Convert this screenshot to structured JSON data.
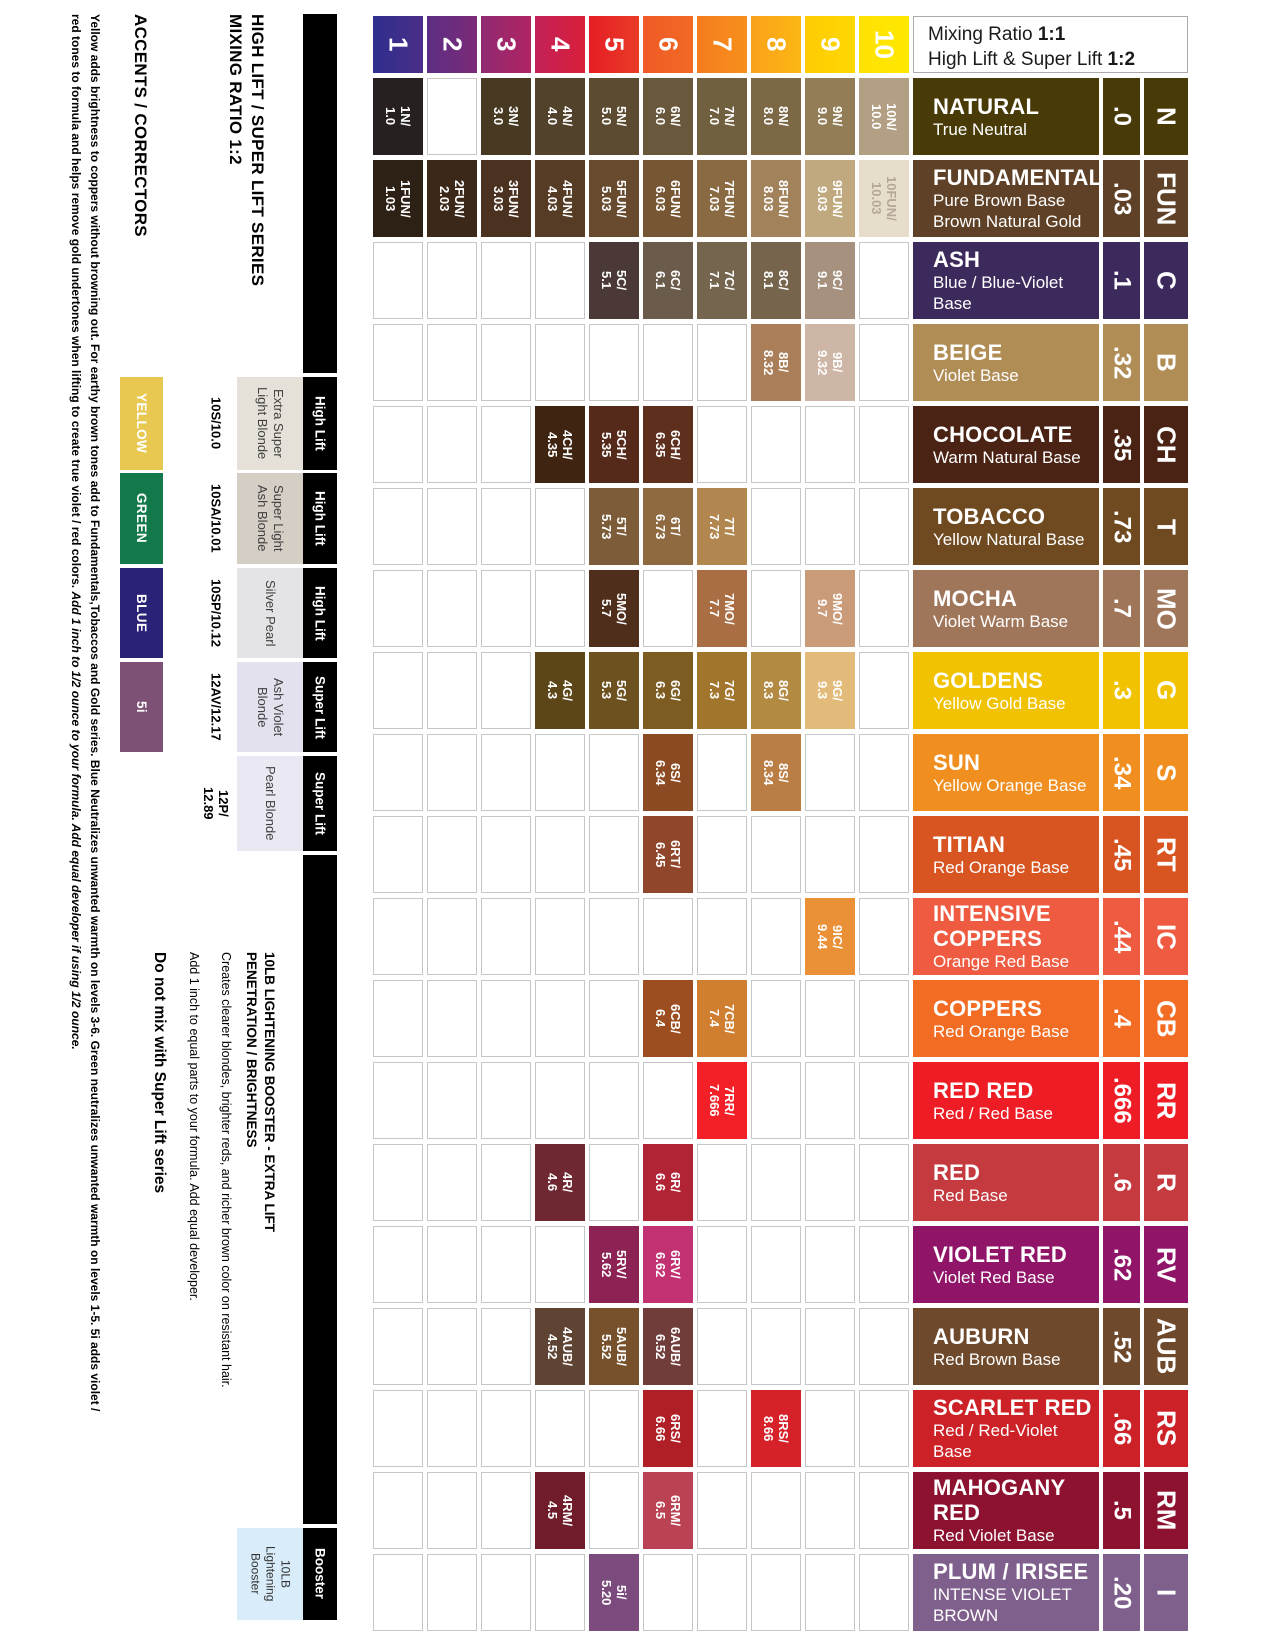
{
  "headings": {
    "series_line1": "HIGH LIFT / SUPER LIFT SERIES",
    "series_line2": "MIXING RATIO 1:2",
    "accents": "ACCENTS / CORRECTORS"
  },
  "mixing_ratio": {
    "line1_label": "Mixing Ratio ",
    "line1_value": "1:1",
    "line2_label": "High Lift & Super Lift ",
    "line2_value": "1:2"
  },
  "footnote": {
    "line1": "Yellow adds brightness to coppers without browning out. For earthy brown tones add to Fundamentals,Tobaccos and Gold series. Blue Neutralizes unwanted warmth on levels 3-6. Green neutralizes unwanted warmth on levels 1-5. 5i adds violet /",
    "line2": "red tones to formula and helps remove gold undertones when lifting to create true violet / red colors. ",
    "line2_italic": "Add 1 inch to 1/2 ounce to your formula. Add equal developer if using 1/2 ounce."
  },
  "info_block": {
    "heading_line1": "10LB LIGHTENING BOOSTER - EXTRA LIFT",
    "heading_line2": "PENETRATION / BRIGHTNESS",
    "body1": "Creates clearer blondes, brighter reds, and richer brown color on resistant hair.",
    "body2": "Add 1 inch to equal parts to your formula. Add equal developer.",
    "warning": "Do not mix with Super Lift series"
  },
  "levels": [
    {
      "num": "1",
      "color": "#2e2f8e",
      "color2": "#4b2d87"
    },
    {
      "num": "2",
      "color": "#5c2d83",
      "color2": "#7c2b78"
    },
    {
      "num": "3",
      "color": "#8f2a70",
      "color2": "#b02464"
    },
    {
      "num": "4",
      "color": "#c22158",
      "color2": "#d91f3a"
    },
    {
      "num": "5",
      "color": "#e51e25",
      "color2": "#ea3b27"
    },
    {
      "num": "6",
      "color": "#ef5a28",
      "color2": "#f26a23"
    },
    {
      "num": "7",
      "color": "#f47c1e",
      "color2": "#f7901c"
    },
    {
      "num": "8",
      "color": "#f9a11b",
      "color2": "#fcb713"
    },
    {
      "num": "9",
      "color": "#fecb04",
      "color2": "#ffd800"
    },
    {
      "num": "10",
      "color": "#ffe103",
      "color2": "#ffe800"
    }
  ],
  "accents": [
    {
      "label": "YELLOW",
      "color": "#e9c851"
    },
    {
      "label": "GREEN",
      "color": "#13794b"
    },
    {
      "label": "BLUE",
      "color": "#2a2276"
    },
    {
      "label": "5i",
      "color": "#7d5076"
    }
  ],
  "products": [
    {
      "code_lines": [
        "10S/10.0"
      ],
      "name_lines": [
        "Extra Super",
        "Light Blonde"
      ],
      "bg": "#e5e1d8"
    },
    {
      "code_lines": [
        "10SA/10.01"
      ],
      "name_lines": [
        "Super Light",
        "Ash Blonde"
      ],
      "bg": "#d5cec5"
    },
    {
      "code_lines": [
        "10SP/10.12"
      ],
      "name_lines": [
        "Silver Pearl"
      ],
      "bg": "#e4e4e6"
    },
    {
      "code_lines": [
        "12AV/12.17"
      ],
      "name_lines": [
        "Ash Violet",
        "Blonde"
      ],
      "bg": "#e2e1ed"
    },
    {
      "code_lines": [
        "12P/",
        "12.89"
      ],
      "name_lines": [
        "Pearl Blonde"
      ],
      "bg": "#eae9f3"
    }
  ],
  "lift_bar": {
    "segments": [
      "",
      "High Lift",
      "High Lift",
      "High Lift",
      "Super Lift",
      "Super Lift",
      "",
      "Booster"
    ]
  },
  "booster_box": {
    "line1": "10LB",
    "line2": "Lightening",
    "line3": "Booster"
  },
  "families": [
    {
      "name_lines": [
        "NATURAL"
      ],
      "sub_lines": [
        "True Neutral"
      ],
      "color": "#493b08",
      "code": ".0",
      "letter": "N",
      "swatches": [
        {
          "level": 1,
          "code": "1N/",
          "value": "1.0",
          "color": "#262120"
        },
        {
          "level": 3,
          "code": "3N/",
          "value": "3.0",
          "color": "#483a22"
        },
        {
          "level": 4,
          "code": "4N/",
          "value": "4.0",
          "color": "#52422b"
        },
        {
          "level": 5,
          "code": "5N/",
          "value": "5.0",
          "color": "#5c4b31"
        },
        {
          "level": 6,
          "code": "6N/",
          "value": "6.0",
          "color": "#6a583c"
        },
        {
          "level": 7,
          "code": "7N/",
          "value": "7.0",
          "color": "#70603f"
        },
        {
          "level": 8,
          "code": "8N/",
          "value": "8.0",
          "color": "#7c6844"
        },
        {
          "level": 9,
          "code": "9N/",
          "value": "9.0",
          "color": "#927d57"
        },
        {
          "level": 10,
          "code": "10N/",
          "value": "10.0",
          "color": "#b3a084"
        }
      ]
    },
    {
      "name_lines": [
        "FUNDAMENTALS"
      ],
      "sub_lines": [
        "Pure Brown Base",
        "Brown Natural Gold"
      ],
      "color": "#5e4126",
      "code": ".03",
      "letter": "FUN",
      "swatches": [
        {
          "level": 1,
          "code": "1FUN/",
          "value": "1.03",
          "color": "#2d2014"
        },
        {
          "level": 2,
          "code": "2FUN/",
          "value": "2.03",
          "color": "#3b2819"
        },
        {
          "level": 3,
          "code": "3FUN/",
          "value": "3.03",
          "color": "#4b3220"
        },
        {
          "level": 4,
          "code": "4FUN/",
          "value": "4.03",
          "color": "#573c25"
        },
        {
          "level": 5,
          "code": "5FUN/",
          "value": "5.03",
          "color": "#684a2e"
        },
        {
          "level": 6,
          "code": "6FUN/",
          "value": "6.03",
          "color": "#775634"
        },
        {
          "level": 7,
          "code": "7FUN/",
          "value": "7.03",
          "color": "#8a6a42"
        },
        {
          "level": 8,
          "code": "8FUN/",
          "value": "8.03",
          "color": "#a2825a"
        },
        {
          "level": 9,
          "code": "9FUN/",
          "value": "9.03",
          "color": "#c0a87f"
        },
        {
          "level": 10,
          "code": "10FUN/",
          "value": "10.03",
          "color": "#e7ddcb",
          "tc": "#b3a898"
        }
      ]
    },
    {
      "name_lines": [
        "ASH"
      ],
      "sub_lines": [
        "Blue / Blue-Violet Base"
      ],
      "color": "#3d2a5c",
      "code": ".1",
      "letter": "C",
      "swatches": [
        {
          "level": 5,
          "code": "5C/",
          "value": "5.1",
          "color": "#4a3936"
        },
        {
          "level": 6,
          "code": "6C/",
          "value": "6.1",
          "color": "#6a5b4a"
        },
        {
          "level": 7,
          "code": "7C/",
          "value": "7.1",
          "color": "#75654f"
        },
        {
          "level": 8,
          "code": "8C/",
          "value": "8.1",
          "color": "#76644c"
        },
        {
          "level": 9,
          "code": "9C/",
          "value": "9.1",
          "color": "#a6917e"
        }
      ]
    },
    {
      "name_lines": [
        "BEIGE"
      ],
      "sub_lines": [
        "Violet Base"
      ],
      "color": "#b18d56",
      "code": ".32",
      "letter": "B",
      "swatches": [
        {
          "level": 8,
          "code": "8B/",
          "value": "8.32",
          "color": "#a97e58"
        },
        {
          "level": 9,
          "code": "9B/",
          "value": "9.32",
          "color": "#cdb6a5"
        }
      ]
    },
    {
      "name_lines": [
        "CHOCOLATE"
      ],
      "sub_lines": [
        "Warm Natural Base"
      ],
      "color": "#4a2315",
      "code": ".35",
      "letter": "CH",
      "swatches": [
        {
          "level": 4,
          "code": "4CH/",
          "value": "4.35",
          "color": "#3f2412"
        },
        {
          "level": 5,
          "code": "5CH/",
          "value": "5.35",
          "color": "#552a1a"
        },
        {
          "level": 6,
          "code": "6CH/",
          "value": "6.35",
          "color": "#5f2f1d"
        }
      ]
    },
    {
      "name_lines": [
        "TOBACCO"
      ],
      "sub_lines": [
        "Yellow Natural Base"
      ],
      "color": "#6f4a20",
      "code": ".73",
      "letter": "T",
      "swatches": [
        {
          "level": 5,
          "code": "5T/",
          "value": "5.73",
          "color": "#7c5c39"
        },
        {
          "level": 6,
          "code": "6T/",
          "value": "6.73",
          "color": "#8f6a40"
        },
        {
          "level": 7,
          "code": "7T/",
          "value": "7.73",
          "color": "#b2874f"
        }
      ]
    },
    {
      "name_lines": [
        "MOCHA"
      ],
      "sub_lines": [
        "Violet Warm Base"
      ],
      "color": "#a0765a",
      "code": ".7",
      "letter": "MO",
      "swatches": [
        {
          "level": 5,
          "code": "5MO/",
          "value": "5.7",
          "color": "#4f2e1b"
        },
        {
          "level": 7,
          "code": "7MO/",
          "value": "7.7",
          "color": "#a96e43"
        },
        {
          "level": 9,
          "code": "9MO/",
          "value": "9.7",
          "color": "#c99b79"
        }
      ]
    },
    {
      "name_lines": [
        "GOLDENS"
      ],
      "sub_lines": [
        "Yellow Gold Base"
      ],
      "color": "#f0c200",
      "code": ".3",
      "letter": "G",
      "swatches": [
        {
          "level": 4,
          "code": "4G/",
          "value": "4.3",
          "color": "#5c4517"
        },
        {
          "level": 5,
          "code": "5G/",
          "value": "5.3",
          "color": "#6d511e"
        },
        {
          "level": 6,
          "code": "6G/",
          "value": "6.3",
          "color": "#7d5c21"
        },
        {
          "level": 7,
          "code": "7G/",
          "value": "7.3",
          "color": "#a1752c"
        },
        {
          "level": 8,
          "code": "8G/",
          "value": "8.3",
          "color": "#b28a42"
        },
        {
          "level": 9,
          "code": "9G/",
          "value": "9.3",
          "color": "#e2ba79"
        }
      ]
    },
    {
      "name_lines": [
        "SUN"
      ],
      "sub_lines": [
        "Yellow Orange Base"
      ],
      "color": "#f08e1f",
      "code": ".34",
      "letter": "S",
      "swatches": [
        {
          "level": 6,
          "code": "6S/",
          "value": "6.34",
          "color": "#8c4a23"
        },
        {
          "level": 8,
          "code": "8S/",
          "value": "8.34",
          "color": "#ba7d43"
        }
      ]
    },
    {
      "name_lines": [
        "TITIAN"
      ],
      "sub_lines": [
        "Red Orange Base"
      ],
      "color": "#d85420",
      "code": ".45",
      "letter": "RT",
      "swatches": [
        {
          "level": 6,
          "code": "6RT/",
          "value": "6.45",
          "color": "#90462a"
        }
      ]
    },
    {
      "name_lines": [
        "INTENSIVE",
        "COPPERS"
      ],
      "sub_lines": [
        "Orange Red Base"
      ],
      "color": "#ef5b40",
      "code": ".44",
      "letter": "IC",
      "swatches": [
        {
          "level": 9,
          "code": "9IC/",
          "value": "9.44",
          "color": "#ea9036"
        }
      ]
    },
    {
      "name_lines": [
        "COPPERS"
      ],
      "sub_lines": [
        "Red Orange Base"
      ],
      "color": "#f36c23",
      "code": ".4",
      "letter": "CB",
      "swatches": [
        {
          "level": 6,
          "code": "6CB/",
          "value": "6.4",
          "color": "#9c4e20"
        },
        {
          "level": 7,
          "code": "7CB/",
          "value": "7.4",
          "color": "#d07e2f"
        }
      ]
    },
    {
      "name_lines": [
        "RED RED"
      ],
      "sub_lines": [
        "Red / Red Base"
      ],
      "color": "#ee1c24",
      "code": ".666",
      "letter": "RR",
      "swatches": [
        {
          "level": 7,
          "code": "7RR/",
          "value": "7.666",
          "color": "#f32127"
        }
      ]
    },
    {
      "name_lines": [
        "RED"
      ],
      "sub_lines": [
        "Red Base"
      ],
      "color": "#c43a3e",
      "code": ".6",
      "letter": "R",
      "swatches": [
        {
          "level": 4,
          "code": "4R/",
          "value": "4.6",
          "color": "#6f2731"
        },
        {
          "level": 6,
          "code": "6R/",
          "value": "6.6",
          "color": "#b02436"
        }
      ]
    },
    {
      "name_lines": [
        "VIOLET RED"
      ],
      "sub_lines": [
        "Violet Red Base"
      ],
      "color": "#901568",
      "code": ".62",
      "letter": "RV",
      "swatches": [
        {
          "level": 5,
          "code": "5RV/",
          "value": "5.62",
          "color": "#8d2255"
        },
        {
          "level": 6,
          "code": "6RV/",
          "value": "6.62",
          "color": "#c23172"
        }
      ]
    },
    {
      "name_lines": [
        "AUBURN"
      ],
      "sub_lines": [
        "Red Brown Base"
      ],
      "color": "#6f492b",
      "code": ".52",
      "letter": "AUB",
      "swatches": [
        {
          "level": 4,
          "code": "4AUB/",
          "value": "4.52",
          "color": "#5f4434"
        },
        {
          "level": 5,
          "code": "5AUB/",
          "value": "5.52",
          "color": "#76512c"
        },
        {
          "level": 6,
          "code": "6AUB/",
          "value": "6.52",
          "color": "#713d3b"
        }
      ]
    },
    {
      "name_lines": [
        "SCARLET RED"
      ],
      "sub_lines": [
        "Red / Red-Violet Base"
      ],
      "color": "#cb2127",
      "code": ".66",
      "letter": "RS",
      "swatches": [
        {
          "level": 6,
          "code": "6RS/",
          "value": "6.66",
          "color": "#b01f25"
        },
        {
          "level": 8,
          "code": "8RS/",
          "value": "8.66",
          "color": "#d62129"
        }
      ]
    },
    {
      "name_lines": [
        "MAHOGANY RED"
      ],
      "sub_lines": [
        "Red Violet Base"
      ],
      "color": "#8d1230",
      "code": ".5",
      "letter": "RM",
      "swatches": [
        {
          "level": 4,
          "code": "4RM/",
          "value": "4.5",
          "color": "#701c2b"
        },
        {
          "level": 6,
          "code": "6RM/",
          "value": "6.5",
          "color": "#bb4252"
        }
      ]
    },
    {
      "name_lines": [
        "PLUM / IRISEE"
      ],
      "sub_lines": [
        "INTENSE VIOLET",
        "BROWN"
      ],
      "color": "#7f608c",
      "code": ".20",
      "letter": "I",
      "swatches": [
        {
          "level": 5,
          "code": "5i/",
          "value": "5.20",
          "color": "#7b4b7e"
        }
      ]
    }
  ]
}
